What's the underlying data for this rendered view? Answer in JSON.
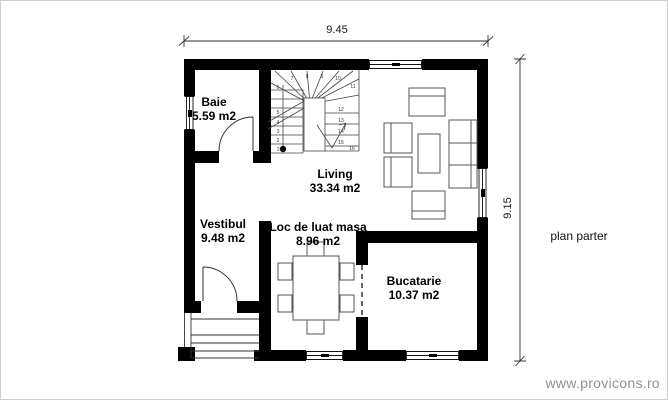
{
  "plan": {
    "caption": "plan parter",
    "watermark": "www.provicons.ro",
    "dimensions": {
      "width": "9.45",
      "height": "9.15"
    },
    "rooms": [
      {
        "name": "Baie",
        "area": "5.59 m2"
      },
      {
        "name": "Living",
        "area": "33.34 m2"
      },
      {
        "name": "Vestibul",
        "area": "9.48 m2"
      },
      {
        "name": "Loc de luat masa",
        "area": "8.96 m2"
      },
      {
        "name": "Bucatarie",
        "area": "10.37 m2"
      }
    ],
    "stairs": {
      "step_numbers": [
        "1",
        "2",
        "3",
        "4",
        "5",
        "6",
        "7",
        "8",
        "9",
        "10",
        "11",
        "12",
        "13",
        "14",
        "15",
        "16"
      ]
    },
    "colors": {
      "wall": "#000000",
      "line": "#3a3a3a",
      "furniture": "#555555",
      "watermark": "#909090",
      "page_border": "#cfcfcf"
    }
  }
}
